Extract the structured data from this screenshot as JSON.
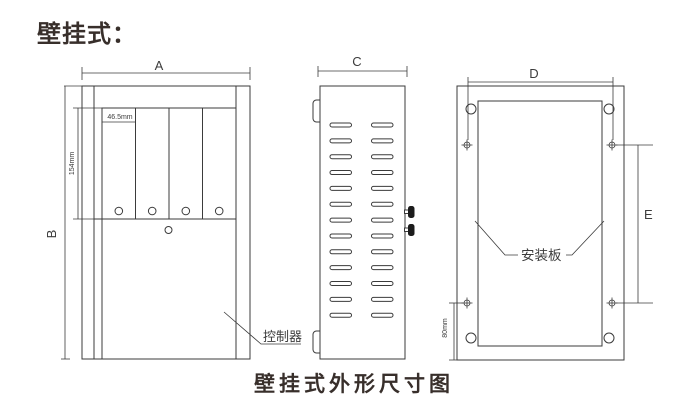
{
  "title": "壁挂式：",
  "caption": "壁挂式外形尺寸图",
  "colors": {
    "line": "#3b3b3b",
    "text": "#382f2b",
    "background": "#ffffff"
  },
  "front_view": {
    "dim_width": "A",
    "dim_height": "B",
    "module_width": "46.5mm",
    "module_height": "154mm",
    "controller_label": "控制器"
  },
  "side_view": {
    "dim_depth": "C",
    "vent": {
      "rows": 13,
      "cols": 2
    }
  },
  "back_view": {
    "dim_hole_width": "D",
    "dim_hole_height": "E",
    "bottom_offset": "80mm",
    "plate_label": "安装板"
  }
}
